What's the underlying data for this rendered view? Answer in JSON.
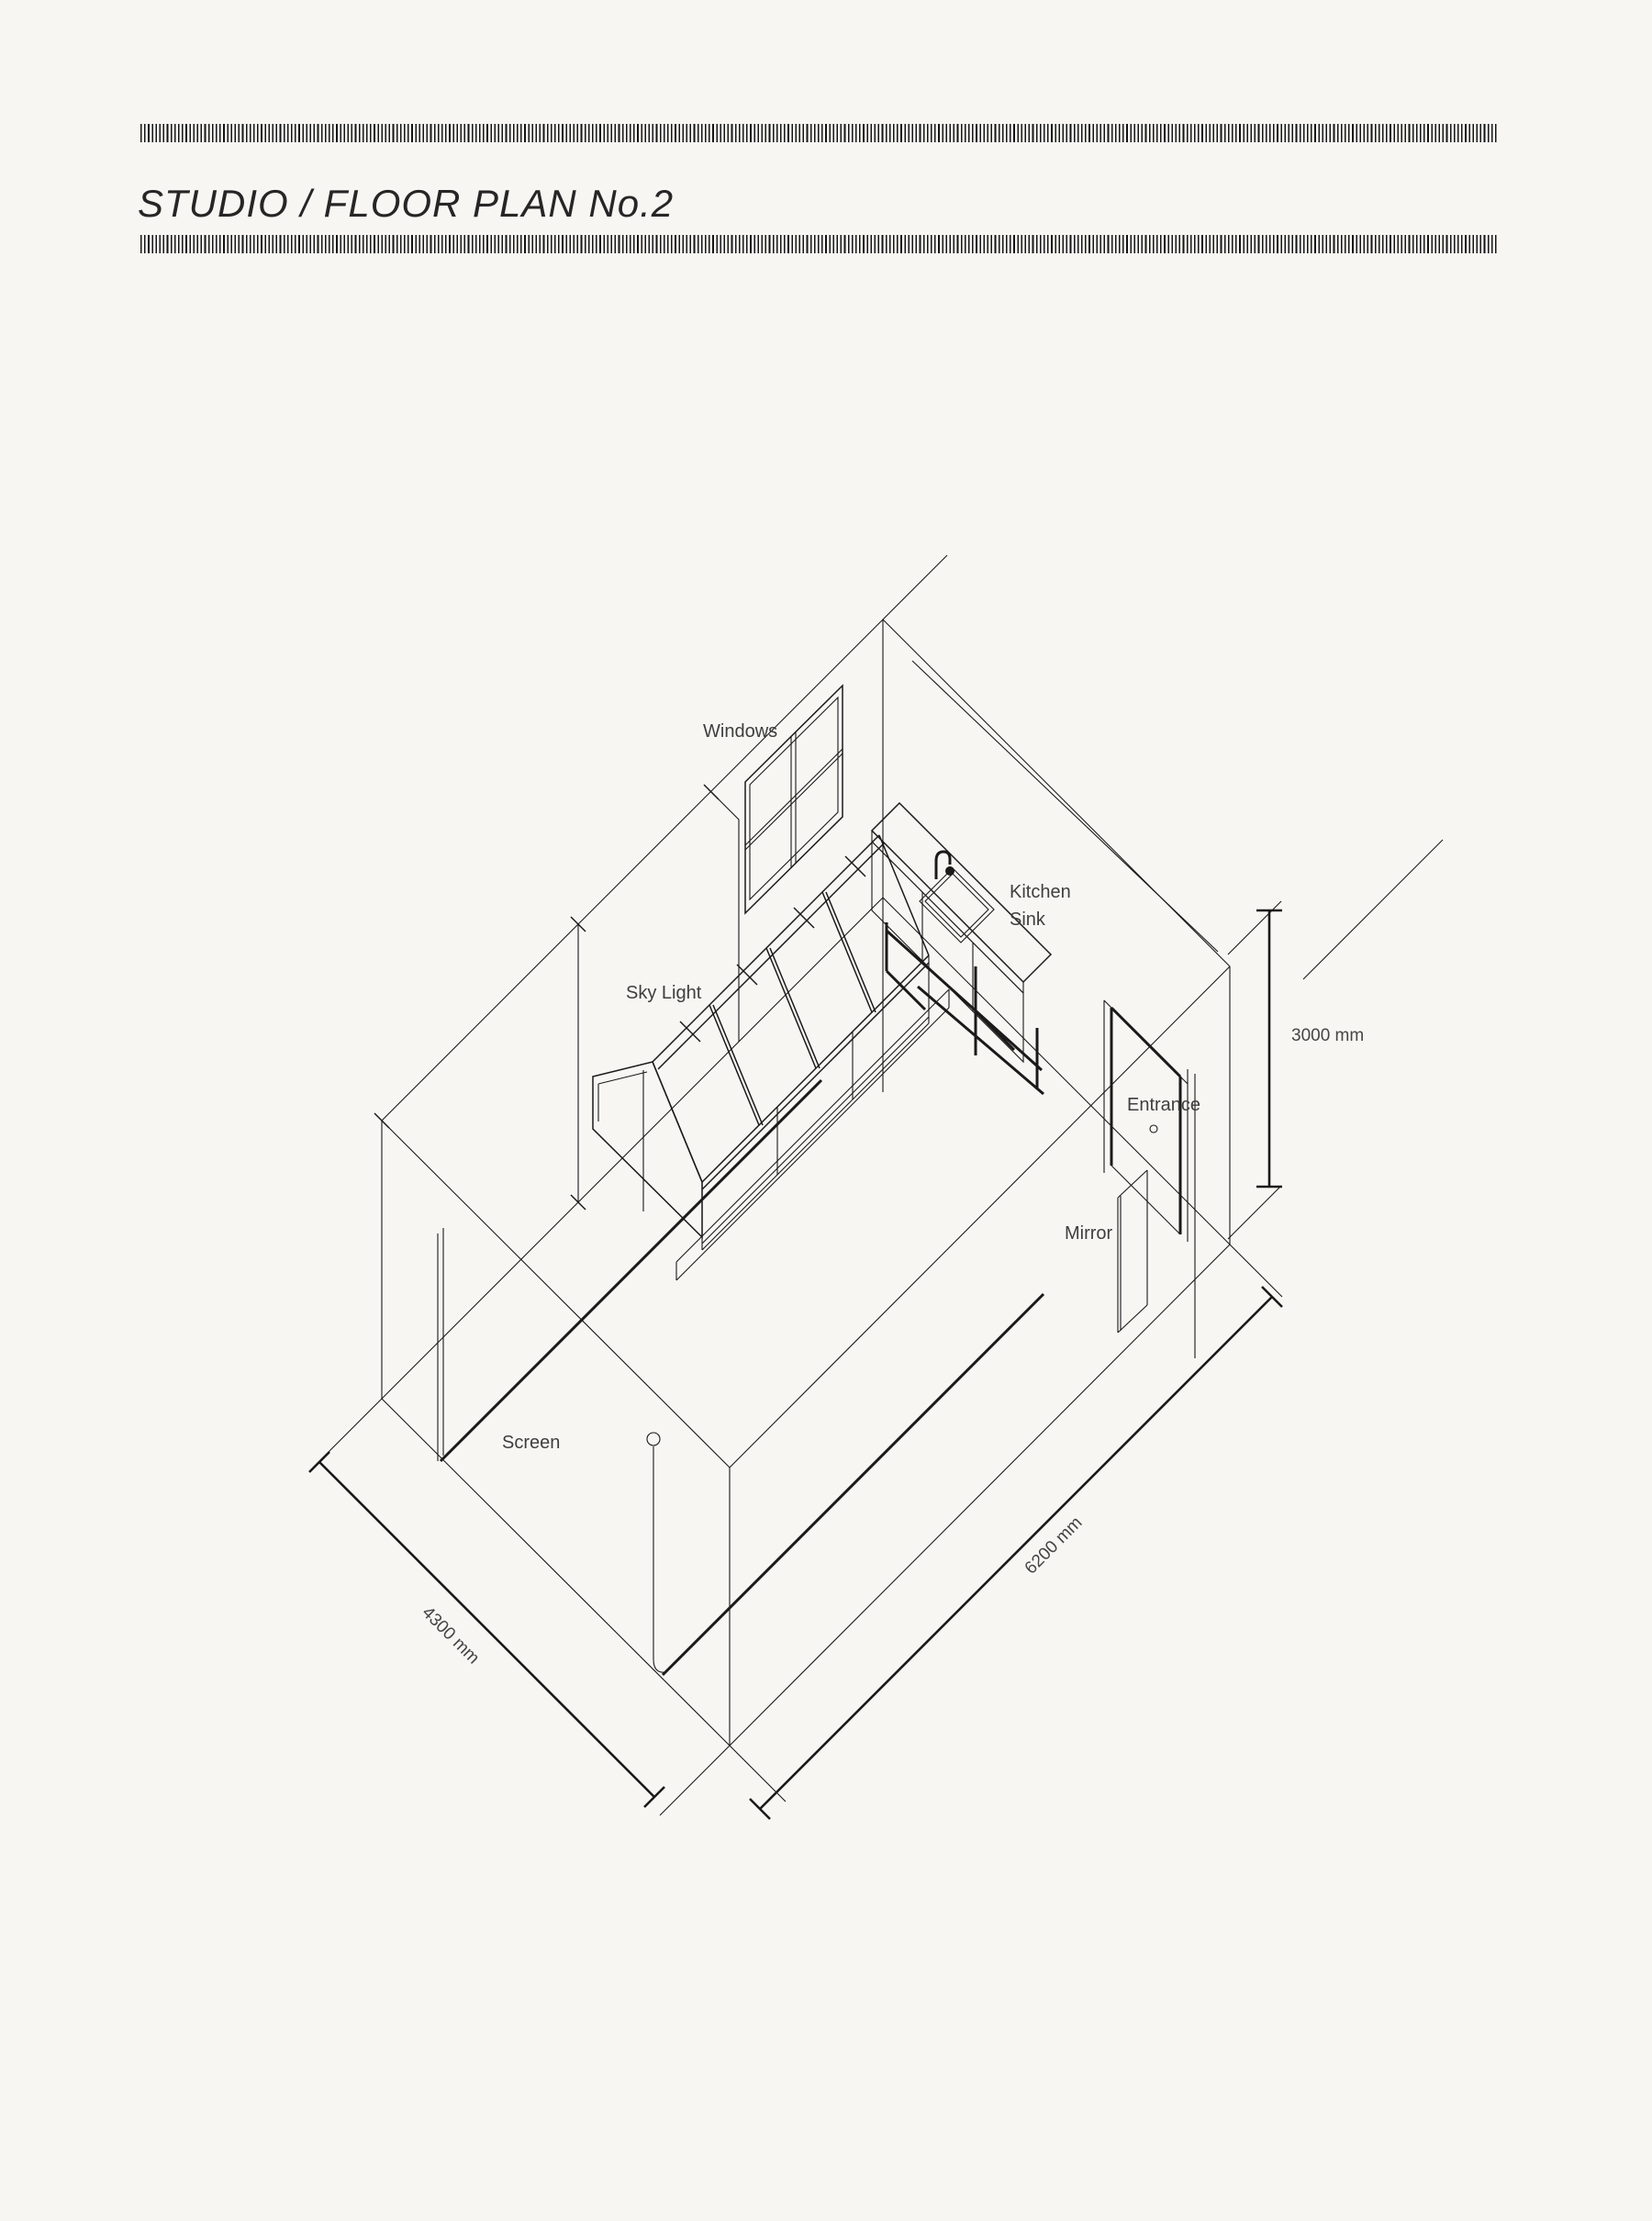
{
  "header": {
    "title": "STUDIO / FLOOR PLAN No.2"
  },
  "drawing": {
    "labels": {
      "windows": "Windows",
      "sky_light": "Sky Light",
      "kitchen": "Kitchen",
      "sink": "Sink",
      "entrance": "Entrance",
      "mirror": "Mirror",
      "screen": "Screen"
    },
    "dimensions": {
      "height": "3000 mm",
      "width": "4300 mm",
      "depth": "6200 mm"
    },
    "colors": {
      "background": "#f7f6f3",
      "line": "#1a1a1a",
      "text": "#3e3e3e"
    }
  }
}
